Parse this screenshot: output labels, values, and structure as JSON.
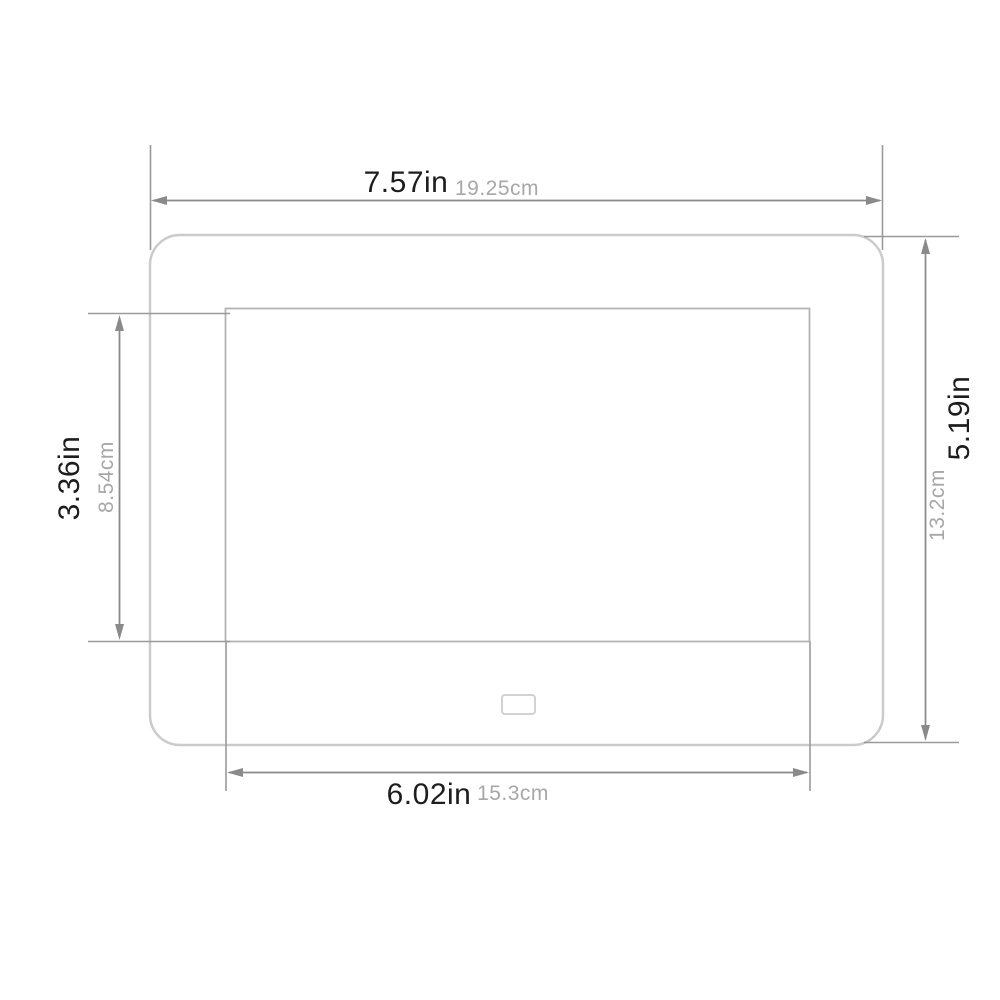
{
  "diagram": {
    "type": "product-dimension-diagram",
    "subject": "digital-photo-frame-front-view",
    "colors": {
      "background": "#ffffff",
      "dimension_line": "#8a8a8a",
      "frame_border": "#cbcbcb",
      "screen_border": "#b3b3b3",
      "sensor_border": "#d2d2d2",
      "label_primary": "#1d1d1d",
      "label_secondary": "#a7a7a7"
    },
    "dimensions": {
      "outer_width": {
        "inches": "7.57in",
        "metric": "19.25cm"
      },
      "outer_height": {
        "inches": "5.19in",
        "metric": "13.2cm"
      },
      "screen_height": {
        "inches": "3.36in",
        "metric": "8.54cm"
      },
      "screen_width": {
        "inches": "6.02in",
        "metric": "15.3cm"
      }
    }
  }
}
